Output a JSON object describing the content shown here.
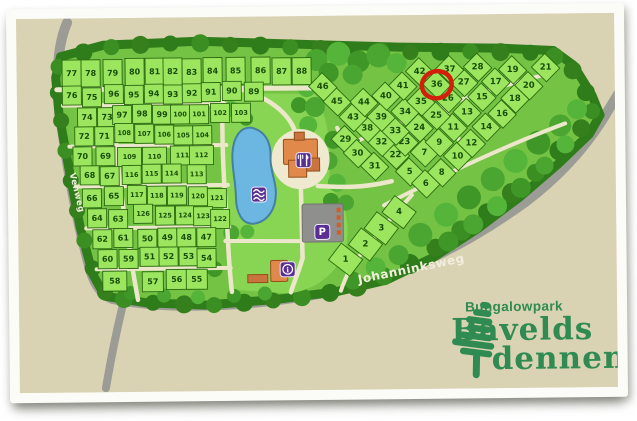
{
  "title": "Plattegrond Bungalowpark Bavelds dennen",
  "logo": {
    "top": "Bungalowpark",
    "name1": "Bavelds",
    "name2": "dennen",
    "color": "#2f8b51"
  },
  "road_labels": [
    {
      "name": "west-road-label",
      "text": "Venweg",
      "x": 70,
      "y": 171,
      "rotate": 77,
      "size": 8.5
    },
    {
      "name": "south-road-label",
      "text": "Johanninksweg",
      "x": 358,
      "y": 284,
      "rotate": -11,
      "size": 12
    }
  ],
  "highlight": {
    "plot": "36",
    "x": 438,
    "y": 86,
    "rx": 15,
    "ry": 13.5,
    "color": "#d2200c"
  },
  "facilities": [
    {
      "type": "swimming",
      "glyph": "waves",
      "x": 259,
      "y": 194
    },
    {
      "type": "restaurant",
      "glyph": "fork-knife",
      "x": 304,
      "y": 160
    },
    {
      "type": "parking",
      "glyph": "P",
      "x": 322,
      "y": 232
    },
    {
      "type": "information",
      "glyph": "i",
      "x": 287,
      "y": 269
    }
  ],
  "colors": {
    "map_bg": "#d9d2b3",
    "road": "#9c9c96",
    "park": "#74c345",
    "fringe": "#2e7c1a",
    "grass": "#88d553",
    "plot": "#9ce55f",
    "plot_border": "#2b6a10",
    "number": "#174d07",
    "path": "#ece7ca",
    "pond": "#6cb6e2",
    "pond_border": "#44809f",
    "plaza": "#efe9d0",
    "building": "#e0894a",
    "building_border": "#934f1d",
    "roof": "#c9743c",
    "parking_lot": "#8f8f8d",
    "badge": "#5b2f91",
    "badge_border": "#eee8f8",
    "tree_dark": [
      "#2e7c1a",
      "#3b8f22",
      "#357f1d"
    ],
    "tree_mid": [
      "#4aa531",
      "#55b43a",
      "#3f9727"
    ],
    "label_white": "#f2eedd",
    "highlight_red": "#d2200c",
    "logo_green": "#2f8b51"
  },
  "map": {
    "plots_grid": [
      [
        77,
        73,
        71
      ],
      [
        78,
        92,
        71
      ],
      [
        79,
        114,
        71
      ],
      [
        80,
        136,
        70
      ],
      [
        81,
        156,
        70
      ],
      [
        82,
        174,
        70
      ],
      [
        83,
        193,
        71
      ],
      [
        84,
        214,
        70
      ],
      [
        85,
        237,
        70
      ],
      [
        86,
        262,
        70
      ],
      [
        87,
        283,
        71
      ],
      [
        88,
        303,
        71
      ],
      [
        76,
        73,
        93
      ],
      [
        75,
        93,
        95
      ],
      [
        96,
        115,
        92
      ],
      [
        95,
        135,
        93
      ],
      [
        94,
        155,
        92
      ],
      [
        93,
        174,
        93
      ],
      [
        92,
        193,
        92
      ],
      [
        91,
        212,
        91
      ],
      [
        90,
        233,
        90
      ],
      [
        89,
        255,
        91
      ],
      [
        74,
        88,
        115
      ],
      [
        73,
        108,
        115
      ],
      [
        97,
        123,
        113
      ],
      [
        98,
        143,
        112
      ],
      [
        99,
        163,
        113
      ],
      [
        100,
        181,
        113
      ],
      [
        101,
        200,
        113
      ],
      [
        102,
        221,
        112
      ],
      [
        103,
        242,
        112
      ],
      [
        72,
        85,
        134
      ],
      [
        71,
        105,
        134
      ],
      [
        108,
        125,
        131
      ],
      [
        107,
        145,
        132
      ],
      [
        106,
        165,
        133
      ],
      [
        105,
        184,
        134
      ],
      [
        104,
        203,
        134
      ],
      [
        70,
        83,
        154
      ],
      [
        69,
        106,
        154
      ],
      [
        109,
        130,
        155
      ],
      [
        110,
        155,
        155
      ],
      [
        111,
        183,
        154
      ],
      [
        112,
        202,
        154
      ],
      [
        68,
        90,
        173
      ],
      [
        67,
        110,
        174
      ],
      [
        116,
        132,
        173
      ],
      [
        115,
        152,
        172
      ],
      [
        114,
        172,
        172
      ],
      [
        113,
        197,
        173
      ],
      [
        66,
        92,
        196
      ],
      [
        65,
        114,
        194
      ],
      [
        117,
        137,
        193
      ],
      [
        118,
        157,
        194
      ],
      [
        119,
        177,
        194
      ],
      [
        120,
        198,
        195
      ],
      [
        121,
        217,
        197
      ],
      [
        64,
        97,
        216
      ],
      [
        63,
        118,
        217
      ],
      [
        126,
        143,
        212
      ],
      [
        125,
        165,
        214
      ],
      [
        124,
        185,
        214
      ],
      [
        123,
        203,
        215
      ],
      [
        122,
        220,
        218
      ],
      [
        62,
        102,
        237
      ],
      [
        61,
        123,
        236
      ],
      [
        50,
        147,
        237
      ],
      [
        49,
        167,
        236
      ],
      [
        48,
        186,
        236
      ],
      [
        47,
        206,
        236
      ],
      [
        60,
        107,
        257
      ],
      [
        59,
        128,
        257
      ],
      [
        51,
        149,
        255
      ],
      [
        52,
        168,
        255
      ],
      [
        53,
        188,
        255
      ],
      [
        54,
        206,
        257
      ],
      [
        58,
        114,
        279
      ],
      [
        57,
        152,
        280
      ],
      [
        56,
        176,
        278
      ],
      [
        55,
        196,
        278
      ]
    ],
    "plots_diamond": [
      [
        1,
        345,
        260
      ],
      [
        2,
        365,
        245
      ],
      [
        3,
        381,
        229
      ],
      [
        4,
        399,
        213
      ],
      [
        5,
        410,
        173
      ],
      [
        6,
        426,
        185
      ],
      [
        7,
        425,
        154
      ],
      [
        8,
        442,
        174
      ],
      [
        9,
        440,
        144
      ],
      [
        10,
        458,
        158
      ],
      [
        11,
        454,
        129
      ],
      [
        12,
        472,
        145
      ],
      [
        13,
        468,
        114
      ],
      [
        14,
        487,
        129
      ],
      [
        15,
        483,
        99
      ],
      [
        16,
        503,
        116
      ],
      [
        17,
        497,
        84
      ],
      [
        18,
        516,
        101
      ],
      [
        19,
        514,
        72
      ],
      [
        20,
        530,
        88
      ],
      [
        21,
        547,
        70
      ],
      [
        22,
        396,
        156
      ],
      [
        23,
        405,
        143
      ],
      [
        24,
        420,
        129
      ],
      [
        25,
        437,
        117
      ],
      [
        26,
        449,
        100
      ],
      [
        27,
        465,
        84
      ],
      [
        28,
        479,
        69
      ],
      [
        29,
        346,
        140
      ],
      [
        30,
        358,
        154
      ],
      [
        31,
        375,
        167
      ],
      [
        32,
        382,
        143
      ],
      [
        33,
        396,
        132
      ],
      [
        34,
        406,
        113
      ],
      [
        35,
        422,
        103
      ],
      [
        36,
        438,
        86
      ],
      [
        37,
        451,
        71
      ],
      [
        38,
        368,
        129
      ],
      [
        39,
        382,
        118
      ],
      [
        40,
        387,
        97
      ],
      [
        41,
        404,
        87
      ],
      [
        42,
        421,
        73
      ],
      [
        43,
        354,
        118
      ],
      [
        44,
        365,
        103
      ],
      [
        45,
        338,
        102
      ],
      [
        46,
        324,
        87
      ]
    ]
  }
}
